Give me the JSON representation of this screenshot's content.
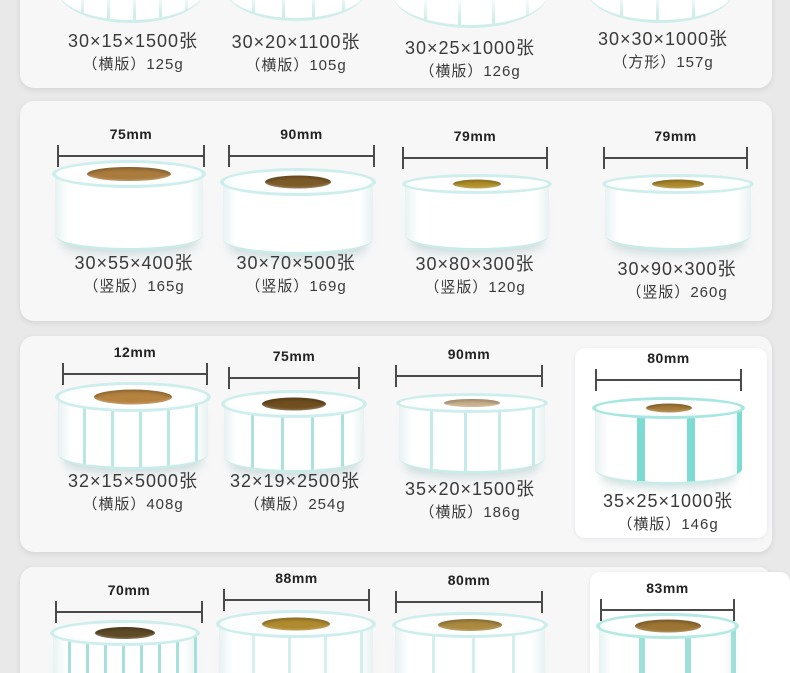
{
  "colors": {
    "page_bg": "#e9e9e9",
    "card_bg": "#f7f7f8",
    "tile_bg": "#ffffff",
    "roll_rim_cyan": "#cdeeec",
    "roll_divider_cyan": "#7edbd4",
    "core_brown": "#a87c3a",
    "dimension_line": "#4a4a4a",
    "text": "#3a3a3a"
  },
  "rows": [
    {
      "products": [
        {
          "size": "30×15×1500张",
          "sub": "（横版）125g"
        },
        {
          "size": "30×20×1100张",
          "sub": "（横版）105g"
        },
        {
          "size": "30×25×1000张",
          "sub": "（横版）126g"
        },
        {
          "size": "30×30×1000张",
          "sub": "（方形）157g"
        }
      ]
    },
    {
      "products": [
        {
          "width_label": "75mm",
          "size": "30×55×400张",
          "sub": "（竖版）165g"
        },
        {
          "width_label": "90mm",
          "size": "30×70×500张",
          "sub": "（竖版）169g"
        },
        {
          "width_label": "79mm",
          "size": "30×80×300张",
          "sub": "（竖版）120g"
        },
        {
          "width_label": "79mm",
          "size": "30×90×300张",
          "sub": "（竖版）260g"
        }
      ]
    },
    {
      "products": [
        {
          "width_label": "12mm",
          "size": "32×15×5000张",
          "sub": "（横版）408g"
        },
        {
          "width_label": "75mm",
          "size": "32×19×2500张",
          "sub": "（横版）254g"
        },
        {
          "width_label": "90mm",
          "size": "35×20×1500张",
          "sub": "（横版）186g"
        },
        {
          "width_label": "80mm",
          "size": "35×25×1000张",
          "sub": "（横版）146g"
        }
      ]
    },
    {
      "products": [
        {
          "width_label": "70mm"
        },
        {
          "width_label": "88mm"
        },
        {
          "width_label": "80mm"
        },
        {
          "width_label": "83mm"
        }
      ]
    }
  ]
}
